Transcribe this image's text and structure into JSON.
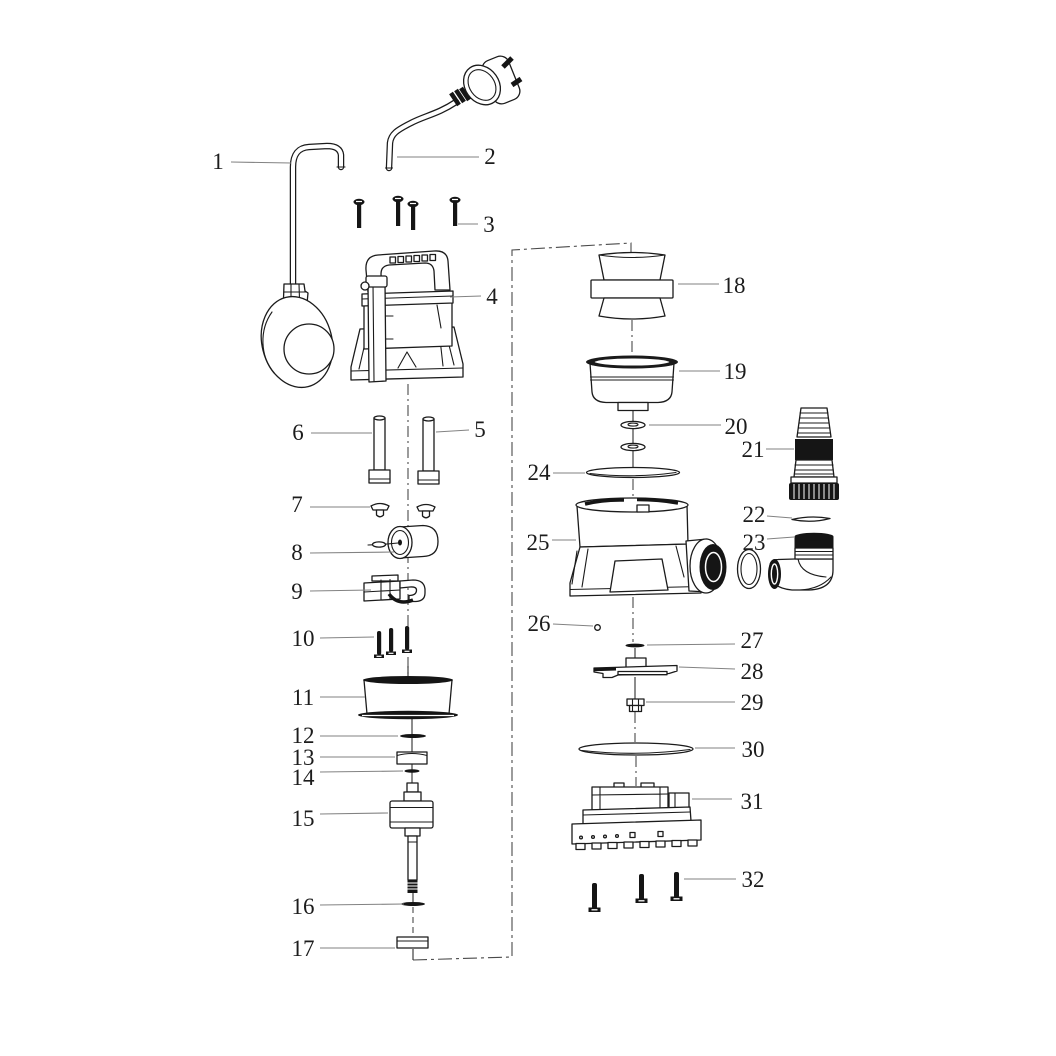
{
  "page": {
    "background": "#ffffff",
    "ink_color": "#1b1b1b",
    "leader_color": "#828282",
    "centerline_color": "#4a4a4a"
  },
  "diagram": {
    "type": "exploded-view-parts-diagram",
    "part_count": 32,
    "callouts": [
      {
        "label": "1",
        "tx": 218,
        "ty": 161,
        "x1": 231,
        "y1": 162,
        "x2": 291,
        "y2": 163
      },
      {
        "label": "2",
        "tx": 490,
        "ty": 156,
        "x1": 397,
        "y1": 157,
        "x2": 479,
        "y2": 157
      },
      {
        "label": "3",
        "tx": 489,
        "ty": 224,
        "x1": 458,
        "y1": 224,
        "x2": 478,
        "y2": 224
      },
      {
        "label": "4",
        "tx": 492,
        "ty": 296,
        "x1": 450,
        "y1": 297,
        "x2": 481,
        "y2": 296
      },
      {
        "label": "5",
        "tx": 480,
        "ty": 429,
        "x1": 436,
        "y1": 432,
        "x2": 469,
        "y2": 430
      },
      {
        "label": "6",
        "tx": 298,
        "ty": 432,
        "x1": 311,
        "y1": 433,
        "x2": 372,
        "y2": 433
      },
      {
        "label": "7",
        "tx": 297,
        "ty": 504,
        "x1": 310,
        "y1": 507,
        "x2": 370,
        "y2": 507
      },
      {
        "label": "8",
        "tx": 297,
        "ty": 552,
        "x1": 310,
        "y1": 553,
        "x2": 394,
        "y2": 552
      },
      {
        "label": "9",
        "tx": 297,
        "ty": 591,
        "x1": 310,
        "y1": 591,
        "x2": 371,
        "y2": 590
      },
      {
        "label": "10",
        "tx": 303,
        "ty": 638,
        "x1": 320,
        "y1": 638,
        "x2": 374,
        "y2": 637
      },
      {
        "label": "11",
        "tx": 303,
        "ty": 697,
        "x1": 320,
        "y1": 697,
        "x2": 365,
        "y2": 697
      },
      {
        "label": "12",
        "tx": 303,
        "ty": 735,
        "x1": 320,
        "y1": 736,
        "x2": 398,
        "y2": 736
      },
      {
        "label": "13",
        "tx": 303,
        "ty": 757,
        "x1": 320,
        "y1": 757,
        "x2": 395,
        "y2": 757
      },
      {
        "label": "14",
        "tx": 303,
        "ty": 777,
        "x1": 320,
        "y1": 772,
        "x2": 403,
        "y2": 771
      },
      {
        "label": "15",
        "tx": 303,
        "ty": 818,
        "x1": 320,
        "y1": 814,
        "x2": 388,
        "y2": 813
      },
      {
        "label": "16",
        "tx": 303,
        "ty": 906,
        "x1": 320,
        "y1": 905,
        "x2": 404,
        "y2": 904
      },
      {
        "label": "17",
        "tx": 303,
        "ty": 948,
        "x1": 320,
        "y1": 948,
        "x2": 395,
        "y2": 948
      },
      {
        "label": "18",
        "tx": 734,
        "ty": 285,
        "x1": 678,
        "y1": 284,
        "x2": 719,
        "y2": 284
      },
      {
        "label": "19",
        "tx": 735,
        "ty": 371,
        "x1": 679,
        "y1": 371,
        "x2": 720,
        "y2": 371
      },
      {
        "label": "20",
        "tx": 736,
        "ty": 426,
        "x1": 649,
        "y1": 425,
        "x2": 721,
        "y2": 425
      },
      {
        "label": "21",
        "tx": 753,
        "ty": 449,
        "x1": 766,
        "y1": 449,
        "x2": 794,
        "y2": 449
      },
      {
        "label": "22",
        "tx": 754,
        "ty": 514,
        "x1": 767,
        "y1": 516,
        "x2": 792,
        "y2": 518
      },
      {
        "label": "23",
        "tx": 754,
        "ty": 542,
        "x1": 767,
        "y1": 539,
        "x2": 794,
        "y2": 537
      },
      {
        "label": "24",
        "tx": 539,
        "ty": 472,
        "x1": 553,
        "y1": 473,
        "x2": 585,
        "y2": 473
      },
      {
        "label": "25",
        "tx": 538,
        "ty": 542,
        "x1": 552,
        "y1": 540,
        "x2": 576,
        "y2": 540
      },
      {
        "label": "26",
        "tx": 539,
        "ty": 623,
        "x1": 553,
        "y1": 624,
        "x2": 593,
        "y2": 626
      },
      {
        "label": "27",
        "tx": 752,
        "ty": 640,
        "x1": 647,
        "y1": 645,
        "x2": 735,
        "y2": 644
      },
      {
        "label": "28",
        "tx": 752,
        "ty": 671,
        "x1": 679,
        "y1": 667,
        "x2": 735,
        "y2": 669
      },
      {
        "label": "29",
        "tx": 752,
        "ty": 702,
        "x1": 646,
        "y1": 702,
        "x2": 735,
        "y2": 702
      },
      {
        "label": "30",
        "tx": 753,
        "ty": 749,
        "x1": 695,
        "y1": 748,
        "x2": 735,
        "y2": 748
      },
      {
        "label": "31",
        "tx": 752,
        "ty": 801,
        "x1": 692,
        "y1": 799,
        "x2": 732,
        "y2": 799
      },
      {
        "label": "32",
        "tx": 753,
        "ty": 879,
        "x1": 684,
        "y1": 879,
        "x2": 736,
        "y2": 879
      }
    ]
  }
}
